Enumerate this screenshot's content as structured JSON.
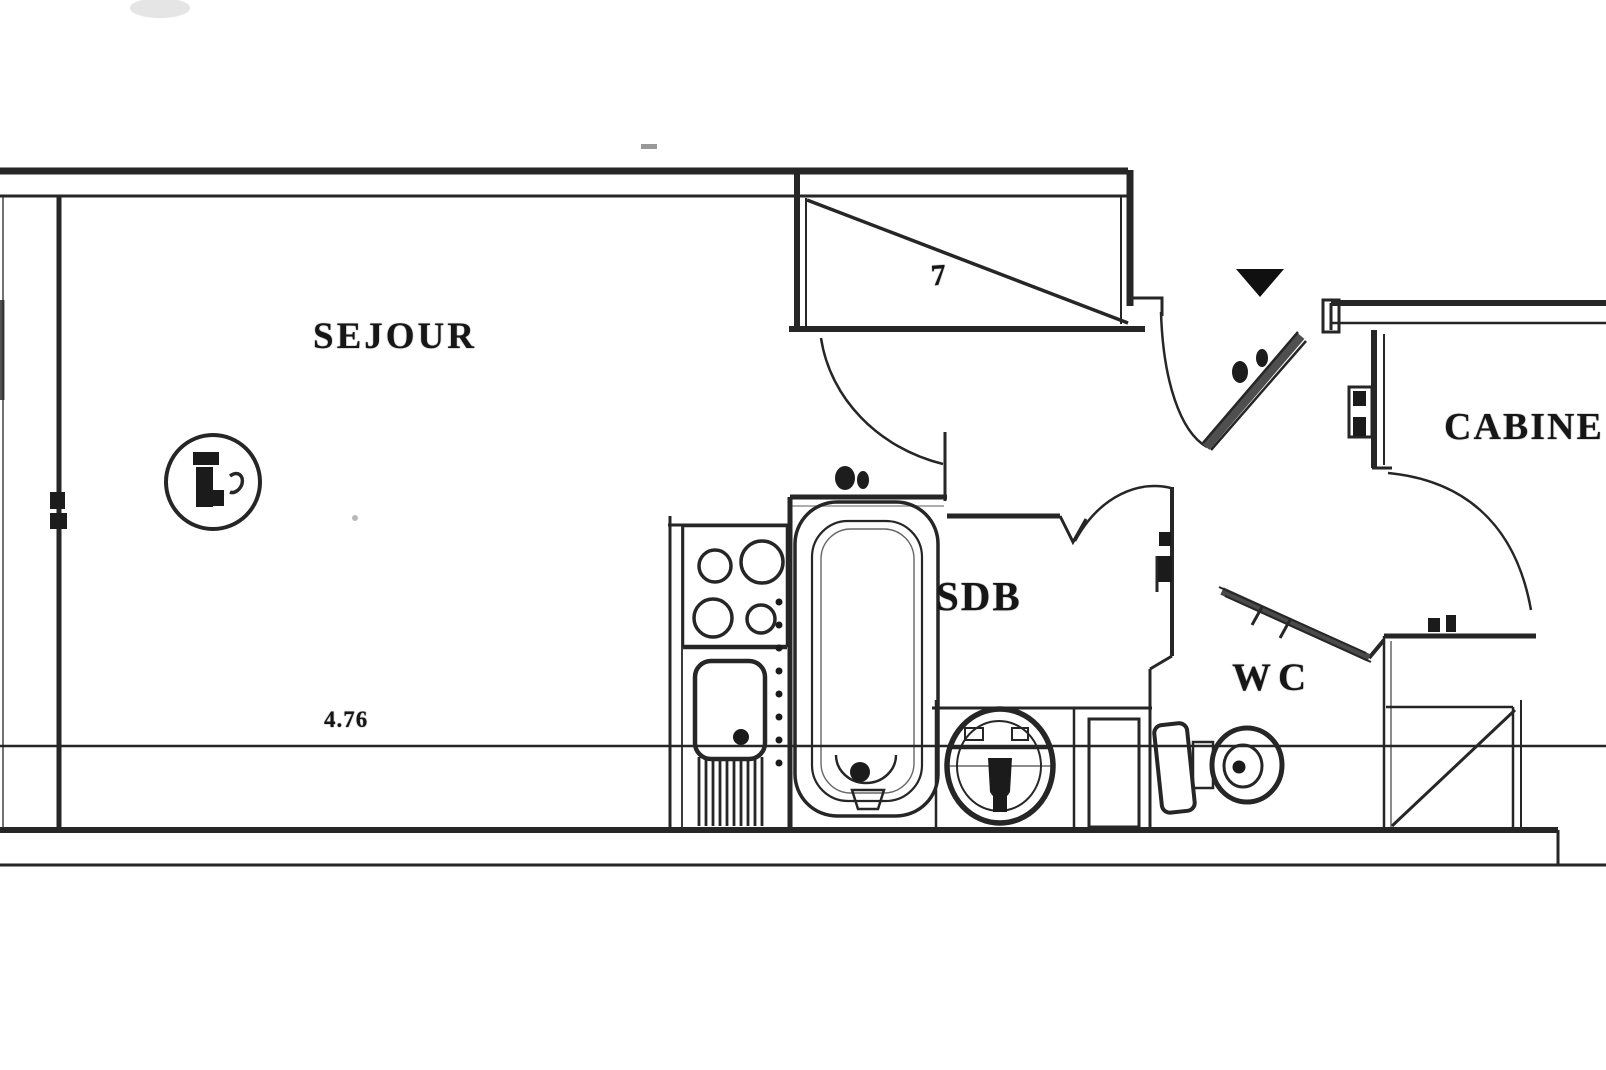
{
  "page": {
    "type": "scanned-floor-plan",
    "background": "#ffffff",
    "ink": "#262626"
  },
  "rooms": {
    "sejour": {
      "label": "SEJOUR"
    },
    "sdb": {
      "label": "SDB"
    },
    "wc": {
      "label": "WC"
    },
    "cabine": {
      "label": "CABINE"
    }
  },
  "annotations": {
    "bottom_dimension": "4.76",
    "closet_mark": "7"
  },
  "fixtures": {
    "hob": "hob-4-burners-icon",
    "kitchen_sink": "kitchen-sink-icon",
    "bathtub": "bathtub-icon",
    "washbasin": "washbasin-icon",
    "toilet": "toilet-icon",
    "entrance_marker": "entrance-triangle-icon",
    "table": "round-table-icon",
    "closets": "closet-diagonal-icon"
  }
}
